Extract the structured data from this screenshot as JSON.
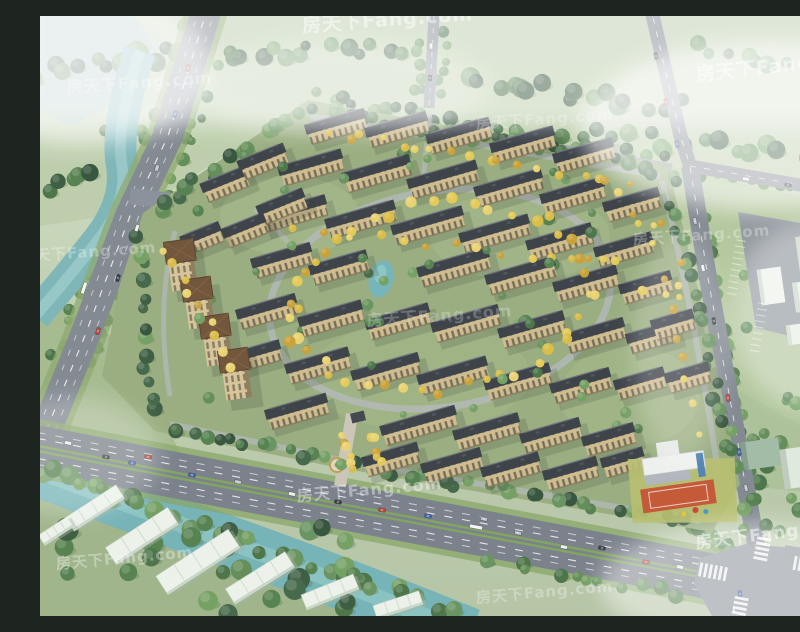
{
  "meta": {
    "type": "aerial-architectural-rendering",
    "subject": "bird's-eye master-plan rendering of a residential community with apartment rows, central pond, perimeter roads, river and highway",
    "canvas": {
      "width": 800,
      "height": 600
    }
  },
  "watermark": {
    "text": "房天下Fang.com",
    "color": "#ffffff",
    "instances": [
      {
        "x": 348,
        "y": 10,
        "rot": -4,
        "opacity": 0.5,
        "size": 19
      },
      {
        "x": 100,
        "y": 72,
        "rot": -4,
        "opacity": 0.33,
        "size": 16
      },
      {
        "x": 742,
        "y": 56,
        "rot": -6,
        "opacity": 0.5,
        "size": 19
      },
      {
        "x": 505,
        "y": 108,
        "rot": -4,
        "opacity": 0.26,
        "size": 15
      },
      {
        "x": 48,
        "y": 241,
        "rot": -4,
        "opacity": 0.3,
        "size": 15
      },
      {
        "x": 662,
        "y": 224,
        "rot": -4,
        "opacity": 0.3,
        "size": 15
      },
      {
        "x": 400,
        "y": 305,
        "rot": -4,
        "opacity": 0.24,
        "size": 16
      },
      {
        "x": 330,
        "y": 479,
        "rot": -5,
        "opacity": 0.4,
        "size": 16
      },
      {
        "x": 733,
        "y": 523,
        "rot": -7,
        "opacity": 0.5,
        "size": 17
      },
      {
        "x": 85,
        "y": 547,
        "rot": -5,
        "opacity": 0.34,
        "size": 15
      },
      {
        "x": 505,
        "y": 581,
        "rot": -5,
        "opacity": 0.3,
        "size": 15
      }
    ]
  },
  "palette": {
    "sky_haze": "#e6eee8",
    "field_light": "#b9cba6",
    "field_dark": "#a9bf96",
    "water": "#79b4b6",
    "water_light": "#a8d1cf",
    "pond": "#6fb2b6",
    "road": "#7d848d",
    "road_light": "#b2b7bb",
    "verge_green": "#7ea25e",
    "lawn": "#95aa7b",
    "roof_dark": "#343a41",
    "roof_ridge": "#6a7077",
    "roof_brown": "#6b4f33",
    "facade": "#cdb98a",
    "facade_shade": "#8a7a55",
    "window_dark": "#4e4a3c",
    "massing_white": "#ebf1e9",
    "massing_shade": "#c8d4c6",
    "court_orange": "#c2522f",
    "marking_white": "#ffffff",
    "tree_greens": [
      "#5d8a52",
      "#4f7d49",
      "#6f9c5d",
      "#456f42",
      "#63905a"
    ],
    "tree_darks": [
      "#3d6342",
      "#35573a",
      "#2f4f36"
    ],
    "tree_yellows": [
      "#d9b93f",
      "#e3c84e",
      "#c79e30",
      "#e8d06a"
    ],
    "car_colors": [
      "#e8eaec",
      "#2e3338",
      "#c23a2e",
      "#3a5fa8",
      "#b9bec4"
    ]
  }
}
